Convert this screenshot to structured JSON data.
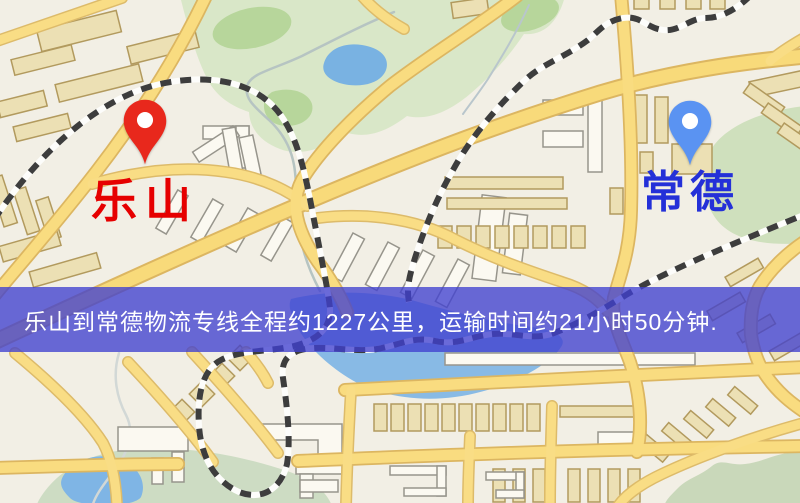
{
  "banner": {
    "text": "乐山到常德物流专线全程约1227公里，运输时间约21小时50分钟.",
    "background_color": "rgba(64,64,208,0.78)",
    "text_color": "#ffffff"
  },
  "markers": {
    "origin": {
      "label": "乐山",
      "label_color": "#e60000",
      "pin_color": "#e8281c",
      "pin_style": "teardrop"
    },
    "destination": {
      "label": "常德",
      "label_color": "#2430d8",
      "pin_color": "#5a93f2",
      "pin_style": "teardrop"
    }
  },
  "map_palette": {
    "background": "#f2efe5",
    "road_fill": "#f8da7a",
    "road_casing": "#dcb661",
    "railway_dark": "#3d3d3d",
    "railway_light": "#fdfdfb",
    "park_green": "#d9e7c8",
    "park_green_dark": "#b7d69b",
    "water_blue": "#86b9e4",
    "building_tan": "#ece0b4",
    "building_white": "#fbf9f1"
  }
}
